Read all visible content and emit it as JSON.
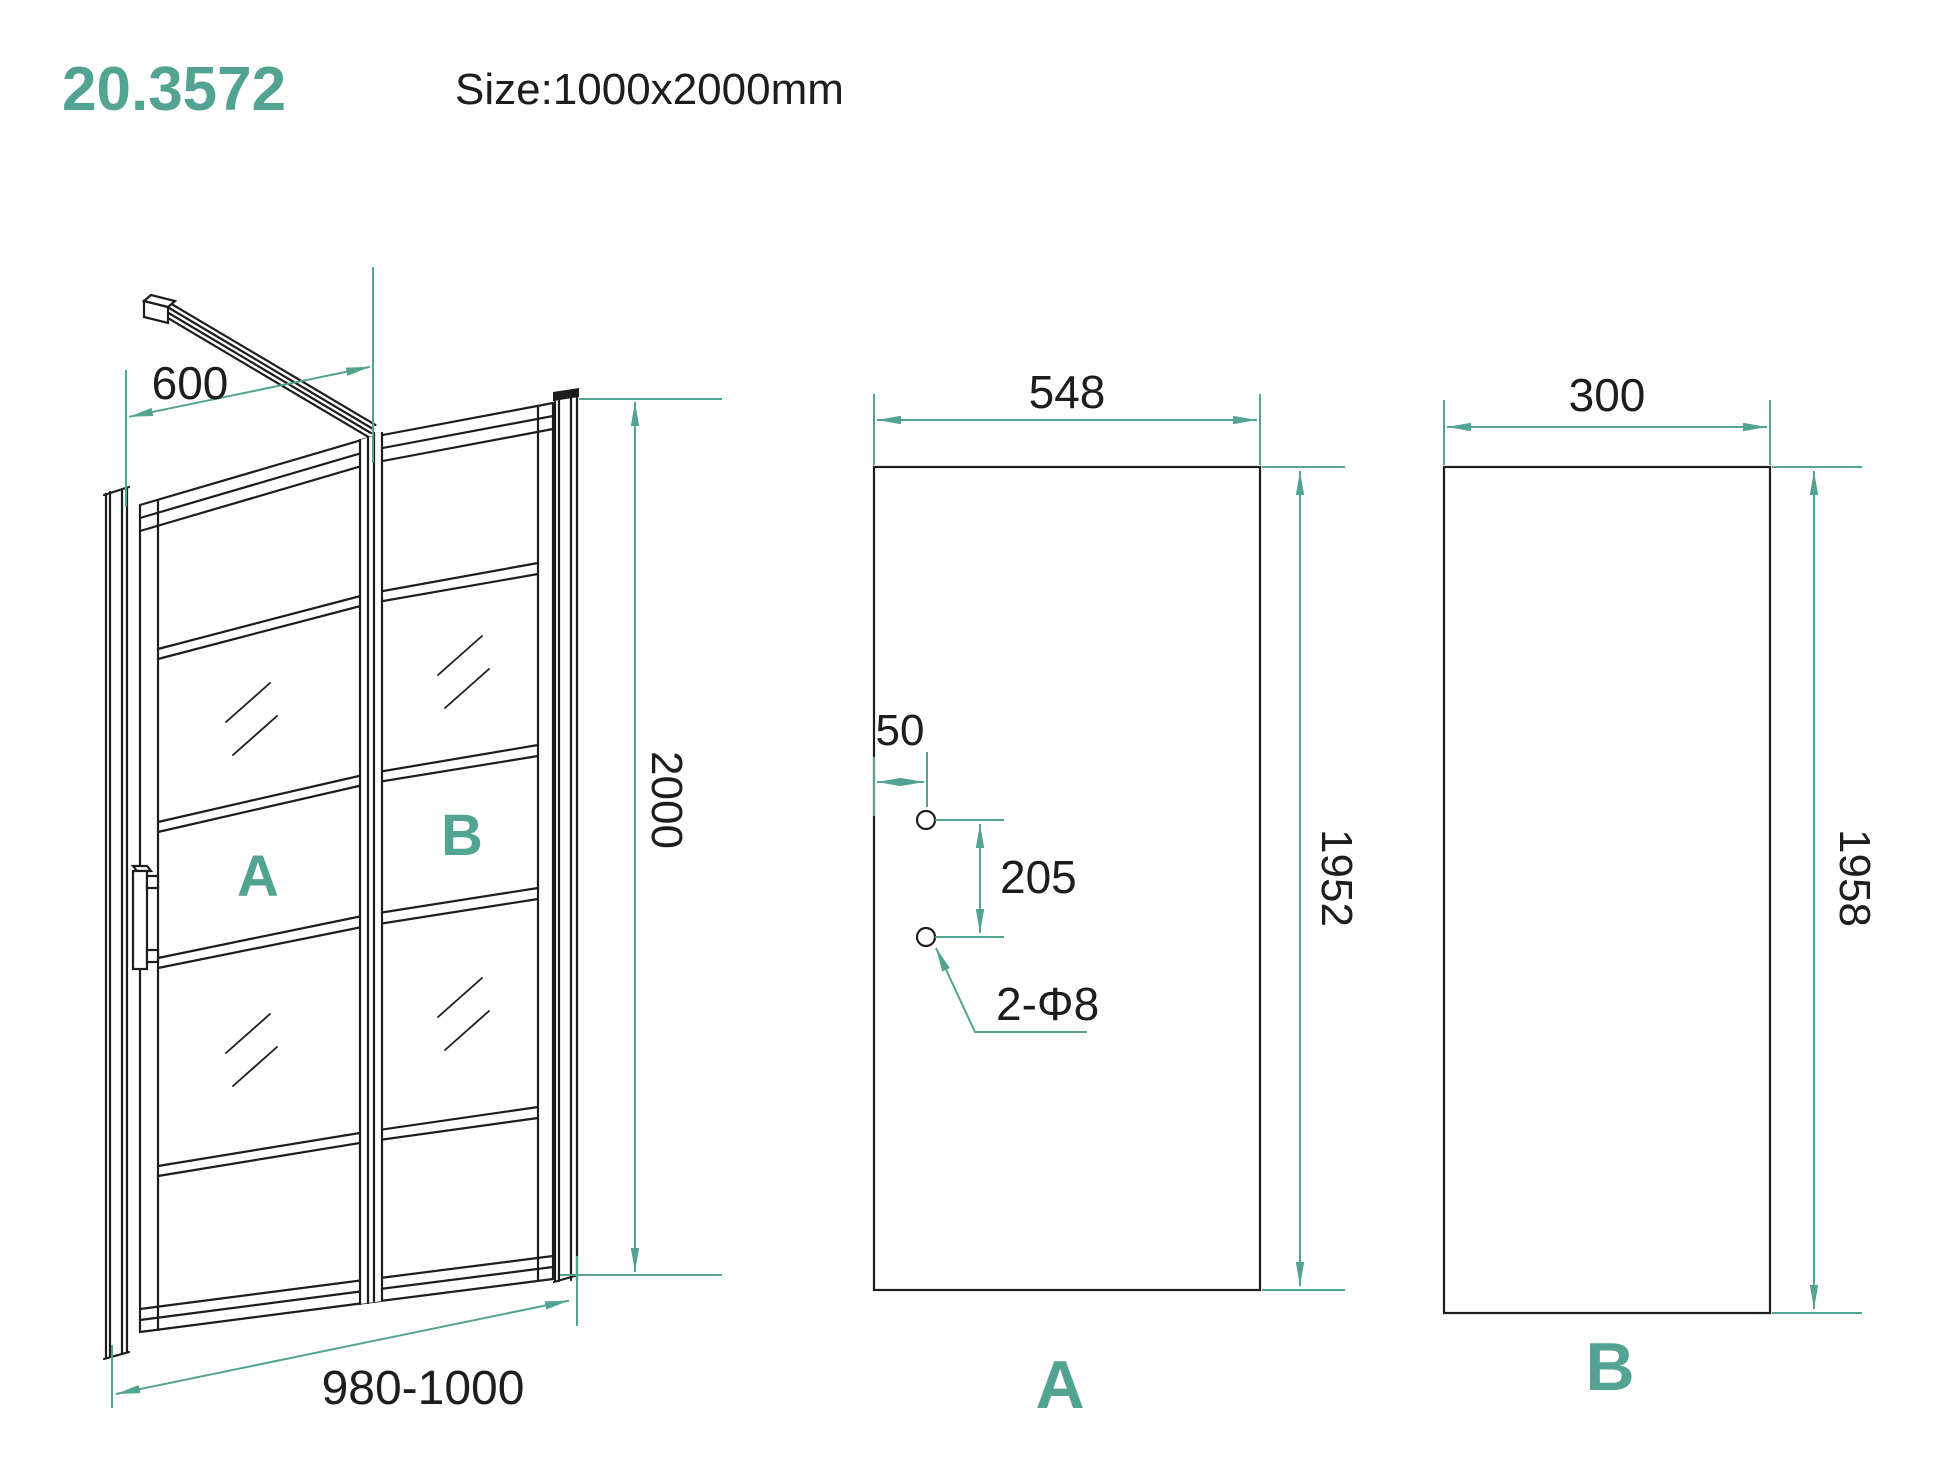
{
  "header": {
    "model": "20.3572",
    "size": "Size:1000x2000mm"
  },
  "colors": {
    "accent_teal": "#52a392",
    "line_black": "#1d1d1b"
  },
  "views": {
    "assembly": {
      "dims": {
        "support_bar_length": "600",
        "total_height": "2000",
        "adjustable_width": "980-1000"
      },
      "labels": {
        "door_panel": "A",
        "fixed_panel": "B"
      }
    },
    "panel_a": {
      "dims": {
        "glass_width": "548",
        "glass_height": "1952",
        "hole_edge_offset": "50",
        "hole_spacing": "205",
        "hole_callout": "2-Φ8"
      },
      "label": "A"
    },
    "panel_b": {
      "dims": {
        "glass_width": "300",
        "glass_height": "1958"
      },
      "label": "B"
    }
  }
}
